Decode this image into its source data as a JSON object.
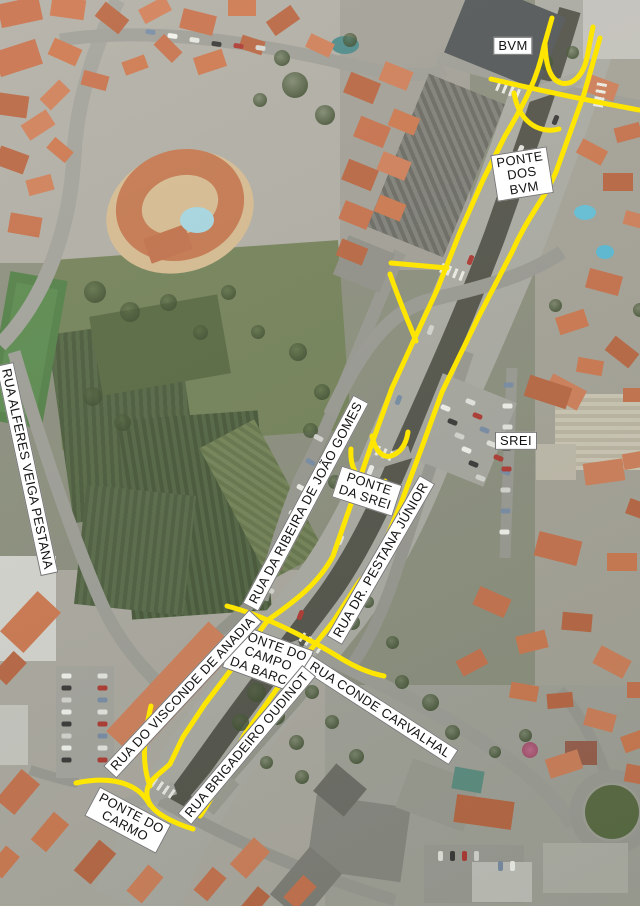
{
  "map": {
    "type": "aerial-photo-with-route-annotations",
    "colors": {
      "route_highlight": "#ffe600",
      "label_background": "#ffffff",
      "label_border": "#767676",
      "label_text": "#131313"
    },
    "labels": [
      {
        "id": "bvm",
        "text": "BVM",
        "x": 513,
        "y": 46,
        "rot": 0,
        "type": "building"
      },
      {
        "id": "ponte-dos-bvm",
        "text": "PONTE\nDOS\nBVM",
        "x": 522,
        "y": 174,
        "rot": -9,
        "type": "bridge"
      },
      {
        "id": "srei",
        "text": "SREI",
        "x": 516,
        "y": 441,
        "rot": 0,
        "type": "building"
      },
      {
        "id": "ponte-da-srei",
        "text": "PONTE\nDA SREI",
        "x": 367,
        "y": 491,
        "rot": 18,
        "type": "bridge"
      },
      {
        "id": "rua-da-ribeira-de-joao-gomes",
        "text": "RUA DA RIBEIRA DE JOÃO GOMES",
        "x": 306,
        "y": 503,
        "rot": -62,
        "type": "street"
      },
      {
        "id": "rua-dr-pestana-junior",
        "text": "RUA DR. PESTANA JÚNIOR",
        "x": 381,
        "y": 560,
        "rot": -60,
        "type": "street"
      },
      {
        "id": "rua-alferes-veiga-pestana",
        "text": "RUA ALFERES VEIGA PESTANA",
        "x": 27,
        "y": 469,
        "rot": 78,
        "type": "street"
      },
      {
        "id": "ponte-do-campo-da-barca",
        "text": "PONTE DO\nCAMPO\nDA BARCA",
        "x": 268,
        "y": 659,
        "rot": 20,
        "type": "bridge"
      },
      {
        "id": "rua-conde-carvalhal",
        "text": "RUA CONDE CARVALHAL",
        "x": 380,
        "y": 710,
        "rot": 33,
        "type": "street"
      },
      {
        "id": "rua-do-visconde-de-anadia",
        "text": "RUA DO VISCONDE DE ANADIA",
        "x": 183,
        "y": 694,
        "rot": -47,
        "type": "street"
      },
      {
        "id": "rua-brigadeiro-oudinot",
        "text": "RUA BRIGADEIRO OUDINOT",
        "x": 247,
        "y": 745,
        "rot": -50,
        "type": "street"
      },
      {
        "id": "ponte-do-carmo",
        "text": "PONTE DO\nCARMO",
        "x": 128,
        "y": 820,
        "rot": 28,
        "type": "bridge"
      }
    ],
    "routes": [
      {
        "name": "main-line-west",
        "d": "M552,18 L544,46 C538,78 524,104 505,136 L483,180 L460,232 L437,290 L413,342 L392,388 L371,446 L351,504 L333,556 C318,584 295,601 268,620 L237,662 L205,704 L183,737 L170,764 C162,772 148,780 147,791 C146,802 153,810 163,816 C173,822 183,826 193,829"
      },
      {
        "name": "main-line-east",
        "d": "M600,38 L584,94 L556,172 C544,200 528,216 512,252 L478,318 L442,392 L422,447 L400,506 L381,551 C372,568 366,574 359,582 L333,622 L308,653 L276,690 L245,734 L226,768 C218,786 210,802 200,816"
      },
      {
        "name": "bvm-u-turn",
        "d": "M545,44 C546,68 551,80 561,83 C573,86 583,75 587,58 C589,47 591,36 593,27"
      },
      {
        "name": "bvm-slip-lane",
        "d": "M514,93 C517,110 524,121 536,127 C545,131 552,131 559,129"
      },
      {
        "name": "bvm-cross-street",
        "d": "M491,79 C530,88 580,99 639,110"
      },
      {
        "name": "joao-gomes-stub",
        "d": "M391,263 L447,268"
      },
      {
        "name": "joao-gomes-merge",
        "d": "M390,274 C397,295 406,316 416,341"
      },
      {
        "name": "srei-u-turn-north",
        "d": "M372,436 C375,451 383,458 391,456 C400,453 406,445 408,432"
      },
      {
        "name": "srei-u-turn-south",
        "d": "M351,449 C350,463 354,473 362,479 C370,485 378,485 385,481"
      },
      {
        "name": "carvalhal-crossing",
        "d": "M227,606 C262,615 305,636 342,659 C360,670 374,674 384,676"
      },
      {
        "name": "carmo-west-branch",
        "d": "M76,783 C100,778 120,780 134,788 C141,792 146,798 150,805"
      },
      {
        "name": "anadia-approach",
        "d": "M151,706 C144,736 141,762 150,786"
      }
    ]
  }
}
